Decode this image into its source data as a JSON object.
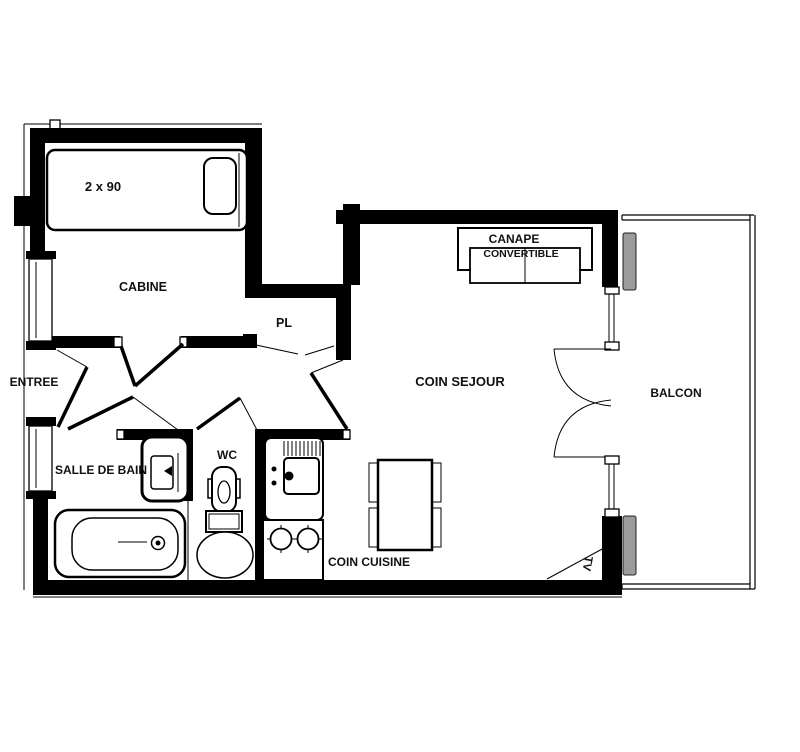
{
  "floorplan": {
    "background": "#ffffff",
    "wall_color": "#000000",
    "glazing_color": "#9b9b9b",
    "labels": {
      "bed_size": "2 x 90",
      "cabine": "CABINE",
      "pl": "PL",
      "entree": "ENTREE",
      "salle_de_bain": "SALLE DE BAIN",
      "wc": "WC",
      "coin_cuisine": "COIN CUISINE",
      "coin_sejour": "COIN SEJOUR",
      "canape_line1": "CANAPE",
      "canape_line2": "CONVERTIBLE",
      "balcon": "BALCON",
      "tv": "TV"
    }
  }
}
